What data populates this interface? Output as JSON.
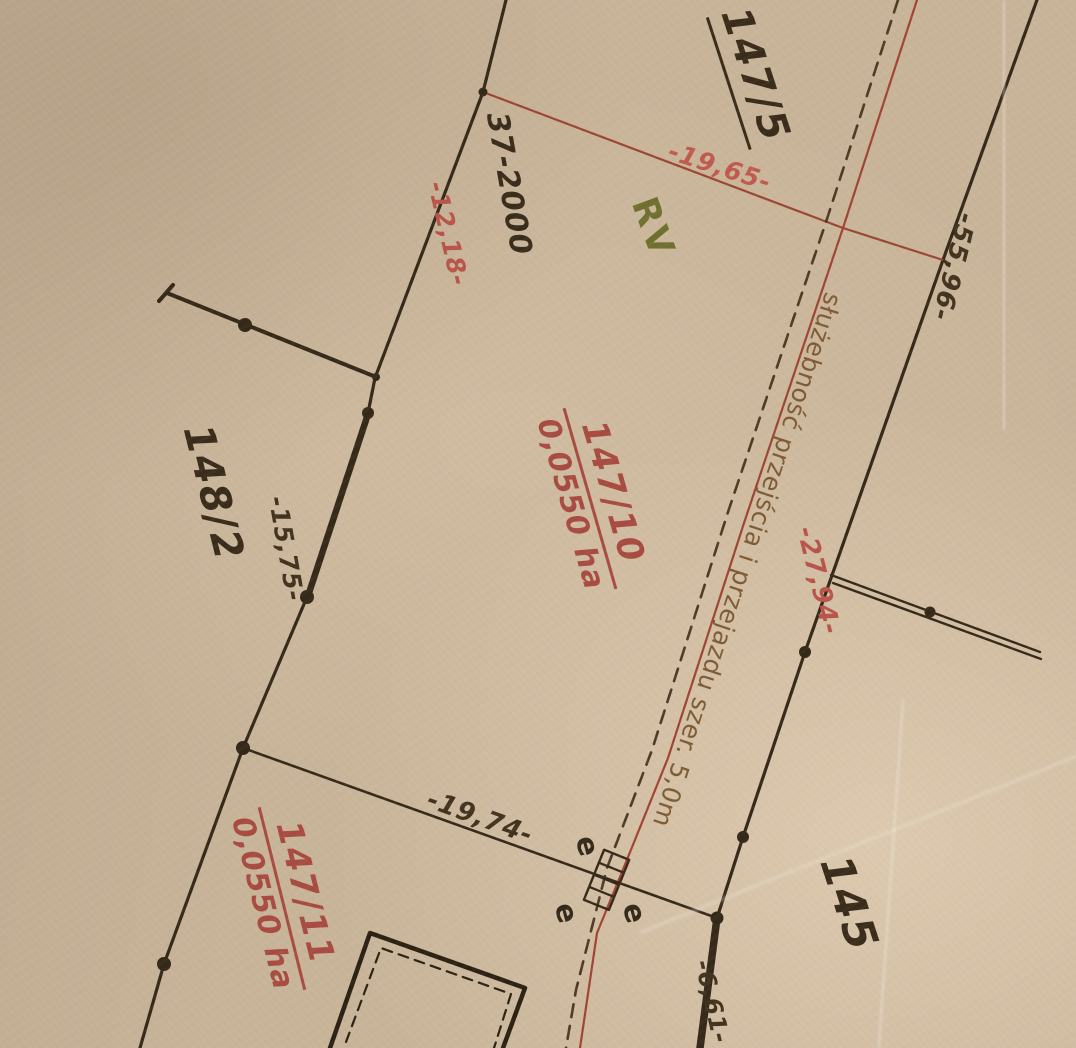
{
  "colors": {
    "paper": "#c8b499",
    "ink_black": "#392c1b",
    "dimension_red": "#b8544a",
    "parcel_red": "#a84b41",
    "land_class_green": "#70702f",
    "easement_brown": "#7e5b34"
  },
  "parcels": {
    "p147_5": {
      "label": "147/5"
    },
    "p37_2000": {
      "label": "37-2000"
    },
    "p148_2": {
      "label": "148/2"
    },
    "p145": {
      "label": "145"
    },
    "p147_10": {
      "label": "147/10",
      "area": "0,0550 ha"
    },
    "p147_11": {
      "label": "147/11",
      "area": "0,0550 ha"
    }
  },
  "land_use": {
    "label": "RV"
  },
  "easement": {
    "label": "służebność przejścia i przejazdu szer. 5,0m"
  },
  "dimensions": {
    "d19_65": "-19,65-",
    "d12_18": "-12,18-",
    "d55_96": "-55,96-",
    "d15_75": "-15,75-",
    "d27_94": "-27,94-",
    "d19_74": "-19,74-",
    "d6_61": "-6,61-"
  },
  "markers": {
    "e": "e"
  }
}
